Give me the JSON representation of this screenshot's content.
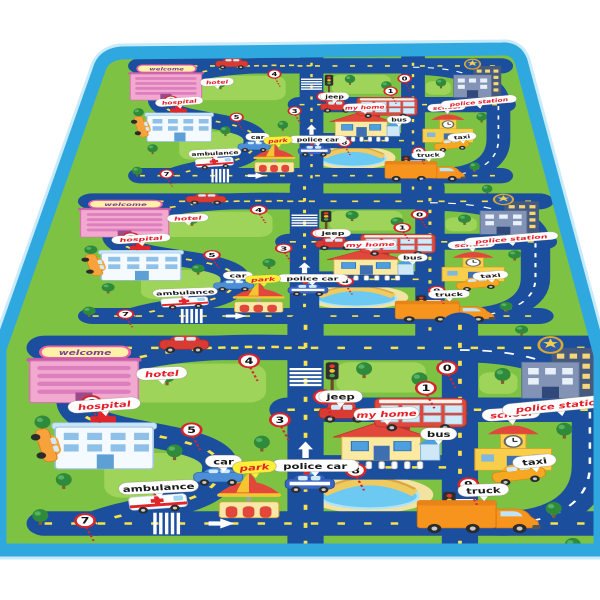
{
  "mat": {
    "welcome_sign": "welcome",
    "colors": {
      "border": "#2FA8E0",
      "border_halo": "#C9EAF9",
      "grass": "#7EC243",
      "grass_light": "#9FD45A",
      "road": "#1C4E9E",
      "road_dash_yellow": "#F9E24A",
      "road_line_white": "#FFFFFF",
      "pond": "#6CC9F2",
      "sand": "#F3E3A1",
      "label_red": "#E51E2A",
      "label_black": "#1A1A1A",
      "tag_yellow": "#FFEF3A",
      "tag_white": "#FFFFFF",
      "tick_red": "#D4262C",
      "number_ring": "#D4262C"
    },
    "labels": [
      {
        "id": "hotel",
        "text": "hotel",
        "x": 150,
        "y": 58,
        "bg": "white",
        "fg": "red",
        "angle": -4
      },
      {
        "id": "hospital",
        "text": "hospital",
        "x": 96,
        "y": 102,
        "bg": "white",
        "fg": "red",
        "angle": -6
      },
      {
        "id": "car",
        "text": "car",
        "x": 208,
        "y": 180,
        "bg": "white",
        "fg": "black",
        "angle": 0
      },
      {
        "id": "ambulance",
        "text": "ambulance",
        "x": 147,
        "y": 216,
        "bg": "white",
        "fg": "black",
        "angle": -4
      },
      {
        "id": "police-car",
        "text": "police car",
        "x": 294,
        "y": 186,
        "bg": "white",
        "fg": "black",
        "angle": 0
      },
      {
        "id": "my-home",
        "text": "my home",
        "x": 361,
        "y": 114,
        "bg": "white",
        "fg": "red",
        "angle": -3
      },
      {
        "id": "park",
        "text": "park",
        "x": 237,
        "y": 188,
        "bg": "yellow",
        "fg": "red",
        "angle": -5
      },
      {
        "id": "jeep",
        "text": "jeep",
        "x": 318,
        "y": 90,
        "bg": "white",
        "fg": "black",
        "angle": 0
      },
      {
        "id": "bus",
        "text": "bus",
        "x": 410,
        "y": 142,
        "bg": "white",
        "fg": "black",
        "angle": 0
      },
      {
        "id": "taxi",
        "text": "taxi",
        "x": 500,
        "y": 180,
        "bg": "white",
        "fg": "black",
        "angle": -8
      },
      {
        "id": "truck",
        "text": "truck",
        "x": 452,
        "y": 220,
        "bg": "white",
        "fg": "black",
        "angle": -3
      },
      {
        "id": "school",
        "text": "school",
        "x": 478,
        "y": 114,
        "bg": "white",
        "fg": "red",
        "angle": -6
      },
      {
        "id": "police-station",
        "text": "police station",
        "x": 524,
        "y": 102,
        "bg": "white",
        "fg": "red",
        "angle": -8
      }
    ],
    "numbers": [
      {
        "n": "0",
        "x": 418,
        "y": 50
      },
      {
        "n": "1",
        "x": 398,
        "y": 78
      },
      {
        "n": "2",
        "x": 302,
        "y": 90
      },
      {
        "n": "3",
        "x": 261,
        "y": 122
      },
      {
        "n": "4",
        "x": 232,
        "y": 40
      },
      {
        "n": "5",
        "x": 178,
        "y": 136
      },
      {
        "n": "6",
        "x": 84,
        "y": 98
      },
      {
        "n": "7",
        "x": 78,
        "y": 262
      },
      {
        "n": "8",
        "x": 332,
        "y": 192
      },
      {
        "n": "9",
        "x": 438,
        "y": 212
      }
    ],
    "buildings": [
      "hotel",
      "hospital",
      "my-home",
      "school",
      "police-station",
      "carousel",
      "pond-bridge"
    ],
    "vehicles": [
      "ambulance",
      "car",
      "police-car",
      "jeep",
      "bus",
      "taxi",
      "truck"
    ]
  }
}
